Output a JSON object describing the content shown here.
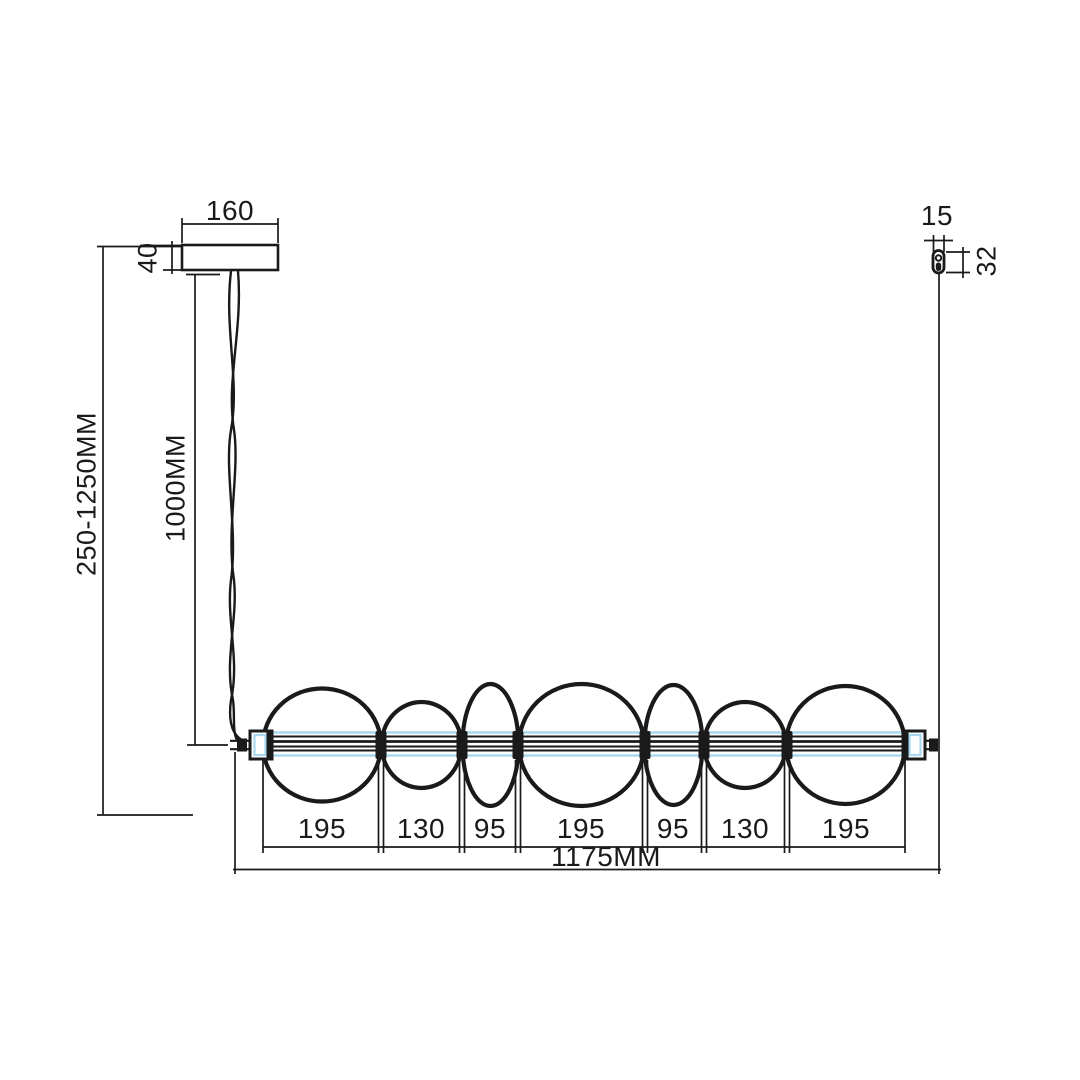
{
  "drawing": {
    "type": "pendant-luminaire-dimension-drawing",
    "colors": {
      "line": "#1a1a1a",
      "glass_tube": "#a9d9f1",
      "background": "#ffffff"
    },
    "dimensions": {
      "canopy_width": "160",
      "canopy_height": "40",
      "suspension_range": "250-1250MM",
      "cable_length": "1000MM",
      "gripper_width": "15",
      "gripper_height": "32",
      "overall_length": "1175MM",
      "segments": [
        "195",
        "130",
        "95",
        "195",
        "95",
        "130",
        "195"
      ]
    }
  }
}
